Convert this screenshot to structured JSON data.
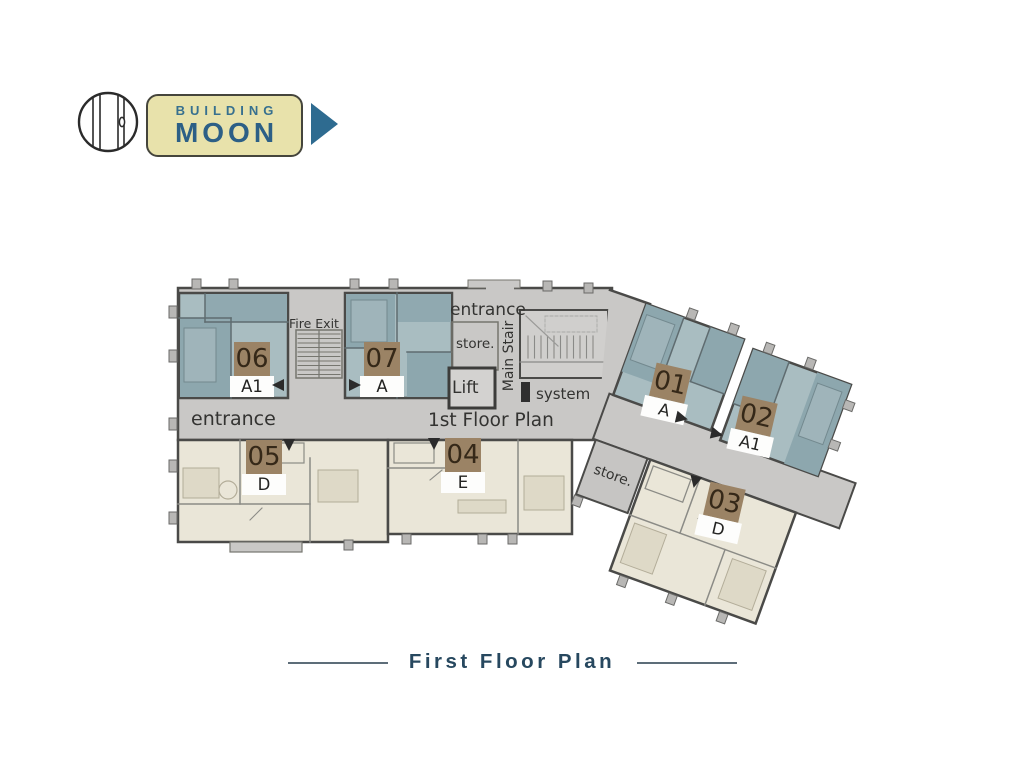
{
  "logo": {
    "building_label": "BUILDING",
    "name": "MOON"
  },
  "plan": {
    "units": [
      {
        "id": "06",
        "type": "A1"
      },
      {
        "id": "07",
        "type": "A"
      },
      {
        "id": "01",
        "type": "A"
      },
      {
        "id": "02",
        "type": "A1"
      },
      {
        "id": "05",
        "type": "D"
      },
      {
        "id": "04",
        "type": "E"
      },
      {
        "id": "03",
        "type": "D"
      }
    ],
    "labels": {
      "fire_exit": "Fire Exit",
      "entrance_top": "entrance",
      "store_top": "store.",
      "main_stair": "Main Stair",
      "lift": "Lift",
      "system": "system",
      "floor_plan": "1st Floor Plan",
      "entrance_left": "entrance",
      "store_wing": "store."
    }
  },
  "footer": {
    "title": "First Floor Plan"
  },
  "colors": {
    "brand_blue": "#2c5f86",
    "badge_fill": "#e8e2ab",
    "arrow_blue": "#2e6b90",
    "unit_blue": "#a9bdc1",
    "unit_blue_dark": "#8da7ae",
    "unit_cream": "#eae6d8",
    "corridor_gray": "#c9c8c6",
    "unit_label_brown": "#9b8365",
    "title_color": "#27485f"
  }
}
